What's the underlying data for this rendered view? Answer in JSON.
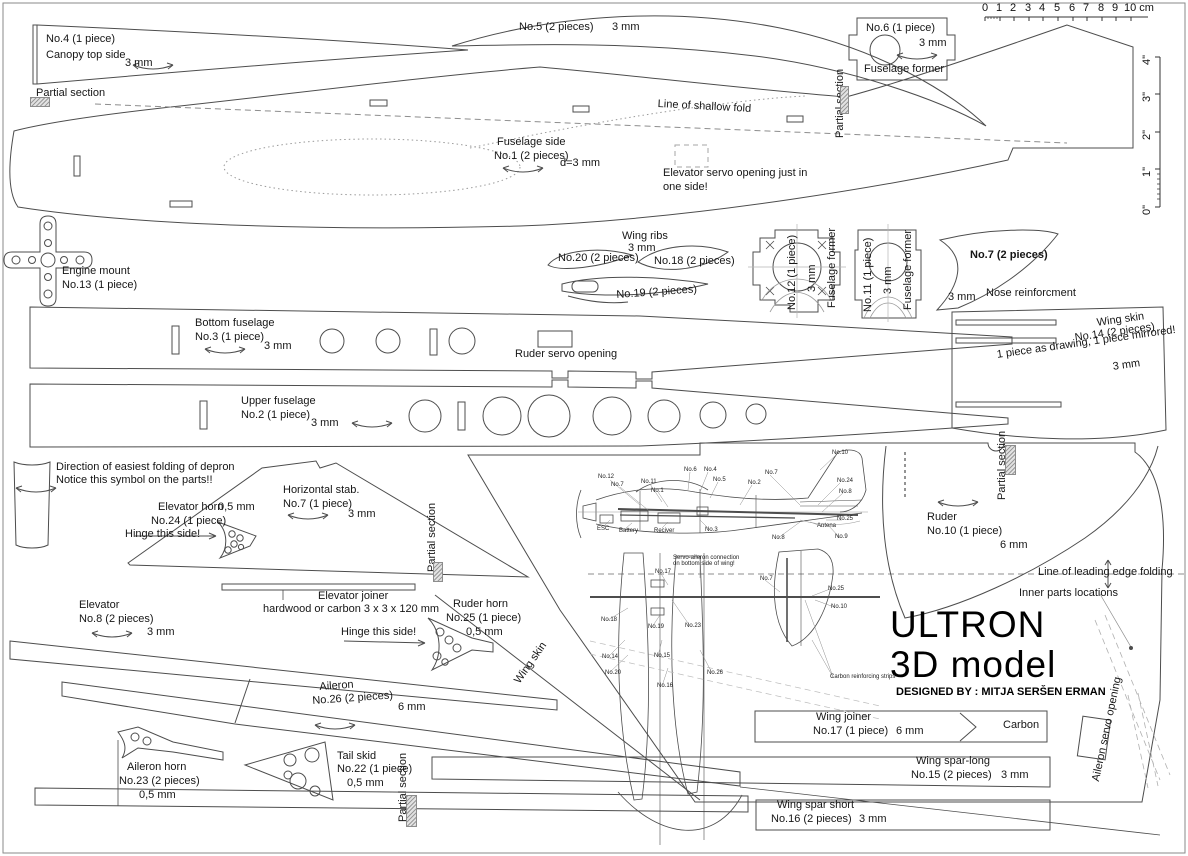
{
  "colors": {
    "line": "#4d4d4d",
    "light_line": "#999999",
    "background": "#ffffff",
    "text": "#161616"
  },
  "title_block": {
    "title": "ULTRON",
    "subtitle": "3D model",
    "designed_by": "DESIGNED BY : MITJA SERŠEN ERMAN"
  },
  "ruler": {
    "cm": [
      "0",
      "1",
      "2",
      "3",
      "4",
      "5",
      "6",
      "7",
      "8",
      "9",
      "10 cm"
    ],
    "inches": [
      "0\"",
      "1\"",
      "2\"",
      "3\"",
      "4\""
    ]
  },
  "labels": {
    "partial_section": "Partial section",
    "canopy": {
      "no": "No.4 (1 piece)",
      "name": "Canopy top side",
      "thick": "3 mm"
    },
    "p5": {
      "no": "No.5 (2 pieces)",
      "thick": "3 mm"
    },
    "shallow_fold": "Line of shallow fold",
    "fus_side": {
      "name": "Fuselage side",
      "no": "No.1 (2 pieces)",
      "thick": "d=3 mm"
    },
    "elev_servo": {
      "l1": "Elevator servo opening just in",
      "l2": "one side!"
    },
    "p6": {
      "no": "No.6 (1 piece)",
      "thick": "3 mm",
      "name": "Fuselage former"
    },
    "engine": {
      "name": "Engine mount",
      "no": "No.13 (1 piece)"
    },
    "wing_ribs": {
      "name": "Wing ribs",
      "thick": "3 mm"
    },
    "p20": "No.20 (2 pieces)",
    "p18": "No.18 (2 pieces)",
    "p19": "No.19 (2 pieces)",
    "p12": {
      "no": "No.12 (1 piece)",
      "thick": "3 mm",
      "name": "Fuselage former"
    },
    "p11": {
      "no": "No.11 (1 piece)",
      "thick": "3 mm",
      "name": "Fuselage former"
    },
    "nose": {
      "no": "No.7 (2 pieces)",
      "name": "Nose reinforcment",
      "thick": "3 mm"
    },
    "bottom_fus": {
      "name": "Bottom fuselage",
      "no": "No.3 (1 piece)",
      "thick": "3 mm"
    },
    "ruder_servo": "Ruder servo opening",
    "wing_skin14": {
      "name": "Wing skin",
      "no": "No.14 (2 pieces)",
      "note": "1 piece as drawing, 1 piece mirrored!",
      "thick": "3 mm"
    },
    "upper_fus": {
      "name": "Upper fuselage",
      "no": "No.2 (1 piece)",
      "thick": "3 mm"
    },
    "depron": {
      "l1": "Direction of easiest folding of depron",
      "l2": "Notice this symbol on the parts!!"
    },
    "hstab": {
      "name": "Horizontal stab.",
      "no": "No.7 (1 piece)",
      "thick": "3 mm"
    },
    "elev_horn": {
      "name": "Elevator horn",
      "thick": "0,5 mm",
      "no": "No.24 (1 piece)",
      "hinge": "Hinge this side!"
    },
    "ruder": {
      "name": "Ruder",
      "no": "No.10 (1 piece)",
      "thick": "6 mm"
    },
    "leading_edge": "Line of leading edge folding",
    "inner_parts": "Inner parts locations",
    "elevator": {
      "name": "Elevator",
      "no": "No.8 (2 pieces)",
      "thick": "3 mm"
    },
    "elev_joiner": {
      "name": "Elevator joiner",
      "spec": "hardwood or carbon 3 x 3 x 120 mm"
    },
    "ruder_horn": {
      "name": "Ruder horn",
      "no": "No.25 (1 piece)",
      "thick": "0,5 mm",
      "hinge": "Hinge this side!"
    },
    "wing_skin_edge": "Wing skin",
    "aileron": {
      "name": "Aileron",
      "no": "No.26 (2 pieces)",
      "thick": "6 mm"
    },
    "aileron_horn": {
      "name": "Aileron horn",
      "no": "No.23 (2 pieces)",
      "thick": "0,5 mm"
    },
    "tail_skid": {
      "name": "Tail skid",
      "no": "No.22 (1 piece)",
      "thick": "0,5 mm"
    },
    "wing_joiner": {
      "name": "Wing joiner",
      "no": "No.17 (1 piece)",
      "thick": "6 mm",
      "material": "Carbon"
    },
    "spar_long": {
      "name": "Wing spar-long",
      "no": "No.15 (2 pieces)",
      "thick": "3 mm"
    },
    "spar_short": {
      "name": "Wing spar short",
      "no": "No.16 (2 pieces)",
      "thick": "3 mm"
    },
    "aileron_servo": "Aileron servo opening"
  },
  "model_view": {
    "side": [
      "No.12",
      "No.7",
      "No.11",
      "No.1",
      "No.6",
      "No.4",
      "No.5",
      "No.2",
      "No.7",
      "No.10",
      "No.24",
      "No.8",
      "No.25",
      "Antena",
      "No.8",
      "No.9",
      "No.3",
      "ESC",
      "Battery",
      "Reciver"
    ],
    "top": [
      "No.17",
      "Servo-aileron connection",
      "on bottom side of wing!",
      "No.7",
      "No.25",
      "No.10",
      "No.18",
      "No.19",
      "No.23",
      "No.14",
      "No.15",
      "No.20",
      "No.16",
      "No.26",
      "Carbon reinforcing strips"
    ]
  }
}
